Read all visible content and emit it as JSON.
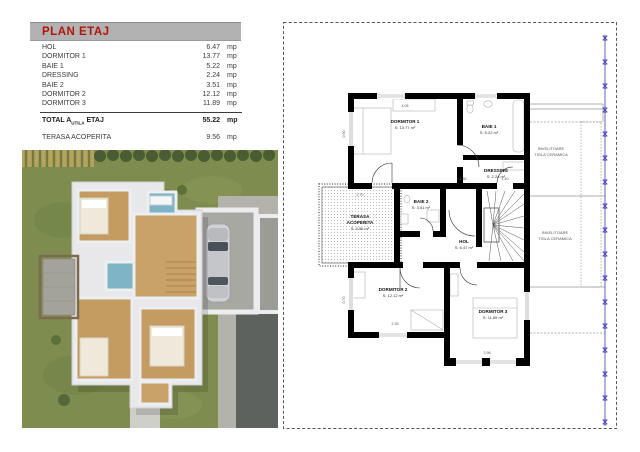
{
  "header": {
    "title": "PLAN ETAJ",
    "title_color": "#b3150c",
    "bar_color": "#b2b2b2"
  },
  "area_table": {
    "rows": [
      {
        "label": "HOL",
        "value": "6.47",
        "unit": "mp"
      },
      {
        "label": "DORMITOR 1",
        "value": "13.77",
        "unit": "mp"
      },
      {
        "label": "BAIE 1",
        "value": "5.22",
        "unit": "mp"
      },
      {
        "label": "DRESSING",
        "value": "2.24",
        "unit": "mp"
      },
      {
        "label": "BAIE 2",
        "value": "3.51",
        "unit": "mp"
      },
      {
        "label": "DORMITOR 2",
        "value": "12.12",
        "unit": "mp"
      },
      {
        "label": "DORMITOR 3",
        "value": "11.89",
        "unit": "mp"
      }
    ],
    "total": {
      "prefix": "TOTAL A",
      "subscript": "UTILA",
      "suffix": "ETAJ",
      "value": "55.22",
      "unit": "mp"
    },
    "terrace": {
      "label": "TERASA ACOPERITA",
      "value": "9.56",
      "unit": "mp"
    }
  },
  "floor_plan": {
    "rooms": {
      "dormitor1": {
        "name": "DORMITOR 1",
        "area": "S: 13.77 m²"
      },
      "baie1": {
        "name": "BAIE 1",
        "area": "S: 5.22 m²"
      },
      "dressing": {
        "name": "DRESSING",
        "area": "S: 2.24 m²"
      },
      "terasa": {
        "name1": "TERASA",
        "name2": "ACOPERITA",
        "area": "S: 9.56 m²"
      },
      "baie2": {
        "name": "BAIE 2",
        "area": "S: 3.51 m²"
      },
      "hol": {
        "name": "HOL",
        "area": "S: 6.47 m²"
      },
      "dormitor2": {
        "name": "DORMITOR 2",
        "area": "S: 12.12 m²"
      },
      "dormitor3": {
        "name": "DORMITOR 3",
        "area": "S: 11.89 m²"
      }
    },
    "roof_label": {
      "line1": "INVELITOARE",
      "line2": "TIGLA CERAMICA"
    },
    "dimensions": {
      "d1": "4.05",
      "d2": "1.30",
      "d3": "1.40",
      "d4": "2.70",
      "d5": "2.35",
      "d6": "2.98",
      "d7": "0.90",
      "d8": "0.70"
    },
    "colors": {
      "wall": "#000000",
      "axis_line": "#3a3aad",
      "roof_line": "#999999"
    }
  }
}
